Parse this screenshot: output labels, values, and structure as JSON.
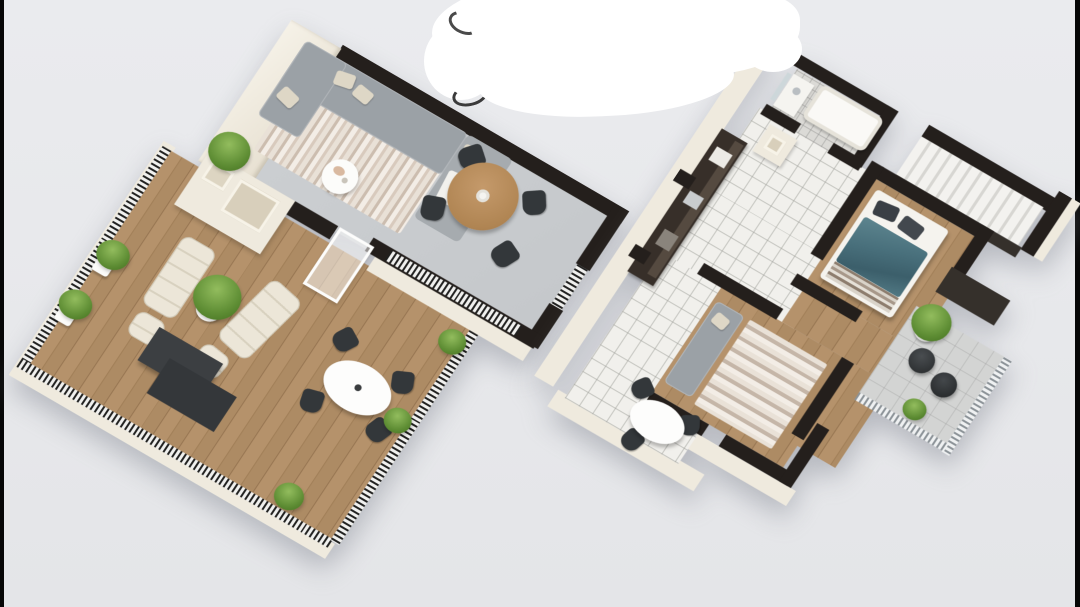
{
  "scene": {
    "title": "3D isometric floor plan rendering, two levels",
    "background_color": "#e9eaec",
    "letterbox_bars": {
      "left": true,
      "right": true,
      "color": "#000000"
    },
    "watermark_overlay": {
      "type": "white-scribble-eraser-blob",
      "color": "#ffffff",
      "pen_mark_color": "#4a4a4a"
    }
  },
  "palette": {
    "wall_top_black": "#241f1c",
    "wall_face_cream": "#efeade",
    "living_floor_gray": "#c9cccf",
    "wood_floor": "#ad8b64",
    "kitchen_tile": "#f1f0ec",
    "bath_tile": "#dbdad6",
    "balcony_tile": "#d3d4d3",
    "sofa_gray": "#9ba1a6",
    "bed_duvet_teal": "#4e7582",
    "plant_green": "#5e8d34",
    "dining_table_wood": "#b98f60",
    "chair_dark": "#33373a",
    "lounge_cream": "#ece6d8"
  },
  "left_plan": {
    "name": "Upper level: living room, dining area and large roof terrace",
    "rooms": [
      {
        "name": "living-room",
        "furniture": [
          "corner-sofa",
          "throw-pillows",
          "white-blanket",
          "striped-rug",
          "round-coffee-table",
          "potted-plant"
        ]
      },
      {
        "name": "dining-area",
        "furniture": [
          "round-wood-dining-table",
          "four-dark-chairs",
          "pendant-lamp"
        ],
        "railing": true
      },
      {
        "name": "terrace",
        "floor": "wood-planks",
        "furniture": [
          "cream-lounge-chair-1",
          "cream-lounge-chair-2",
          "two-ottomans",
          "potted-plant",
          "two-dark-side-tables",
          "white-oval-table",
          "four-dark-chairs",
          "planter-boxes",
          "shrubs"
        ],
        "railing": true
      },
      {
        "name": "chimney-block"
      }
    ]
  },
  "right_plan": {
    "name": "Main level: kitchen, bathroom, bedroom, second room, stairs and balcony",
    "rooms": [
      {
        "name": "bathroom",
        "furniture": [
          "bathtub",
          "washbasin",
          "mirror"
        ],
        "floor": "gray-tile"
      },
      {
        "name": "kitchen",
        "furniture": [
          "dark-cabinet-run",
          "counter-appliances",
          "white-oval-table",
          "dark-chairs"
        ],
        "floor": "white-tile"
      },
      {
        "name": "bedroom",
        "furniture": [
          "double-bed",
          "teal-duvet",
          "dark-pillows",
          "striped-foot-blanket"
        ],
        "floor": "wood-planks"
      },
      {
        "name": "second-room",
        "furniture": [
          "gray-sofa",
          "striped-rug"
        ],
        "floor": "wood-planks"
      },
      {
        "name": "staircase",
        "furniture": [
          "white-steps",
          "dark-stringer"
        ]
      },
      {
        "name": "balcony",
        "furniture": [
          "two-dark-round-chairs",
          "potted-plant",
          "shrub"
        ],
        "railing": true,
        "floor": "gray-tile"
      },
      {
        "name": "chimney-block"
      }
    ]
  }
}
